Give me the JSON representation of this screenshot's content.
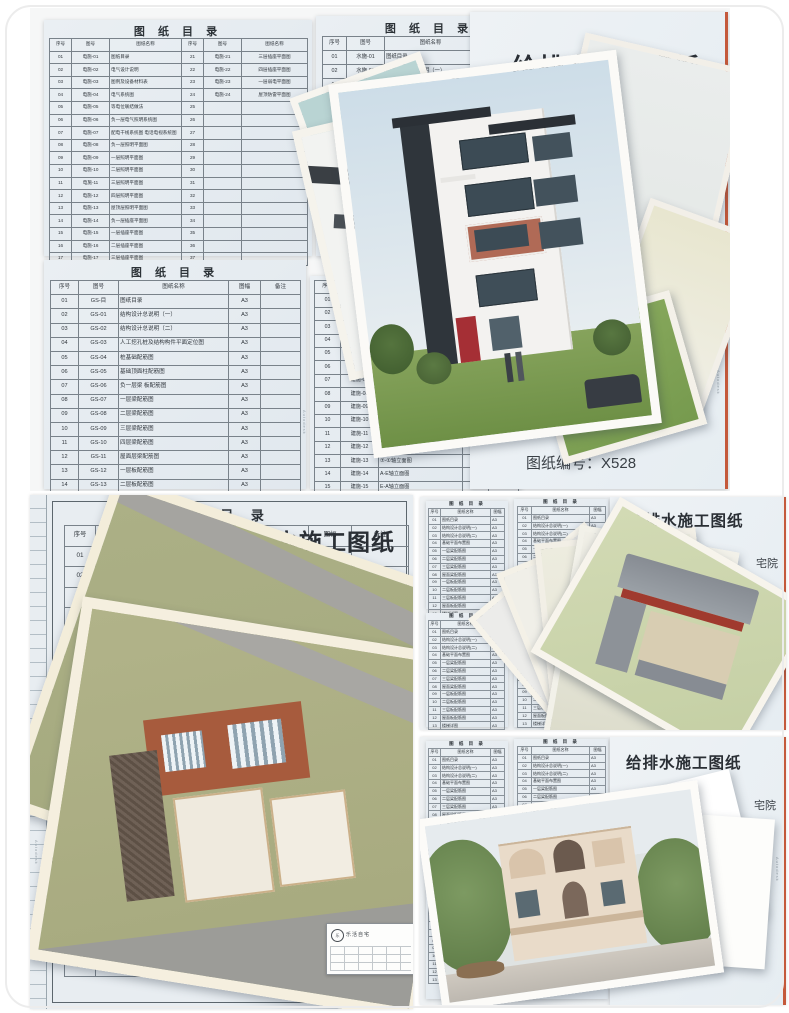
{
  "autodesk": "Autodesk",
  "catalog_title": "图 纸 目 录",
  "top": {
    "dianshi": {
      "heads": [
        "序号",
        "图号",
        "图纸名称",
        "序号",
        "图号",
        "图纸名称"
      ],
      "rows": [
        [
          "01",
          "电施-01",
          "图纸目录",
          "21",
          "电施-21",
          "三层插座平面图"
        ],
        [
          "02",
          "电施-02",
          "电气设计说明",
          "22",
          "电施-22",
          "四层插座平面图"
        ],
        [
          "03",
          "电施-03",
          "图例及设备材料表",
          "23",
          "电施-23",
          "一层弱电平面图"
        ],
        [
          "04",
          "电施-04",
          "电气系统图",
          "24",
          "电施-24",
          "屋顶防雷平面图"
        ],
        [
          "05",
          "电施-05",
          "等电位联结做法",
          "25",
          "",
          ""
        ],
        [
          "06",
          "电施-06",
          "负一层电气照明系统图",
          "26",
          "",
          ""
        ],
        [
          "07",
          "电施-07",
          "配电干线系统图 电话电视系统图",
          "27",
          "",
          ""
        ],
        [
          "08",
          "电施-08",
          "负一层照明平面图",
          "28",
          "",
          ""
        ],
        [
          "09",
          "电施-09",
          "一层照明平面图",
          "29",
          "",
          ""
        ],
        [
          "10",
          "电施-10",
          "二层照明平面图",
          "30",
          "",
          ""
        ],
        [
          "11",
          "电施-11",
          "三层照明平面图",
          "31",
          "",
          ""
        ],
        [
          "12",
          "电施-12",
          "四层照明平面图",
          "32",
          "",
          ""
        ],
        [
          "13",
          "电施-13",
          "屋顶层照明平面图",
          "33",
          "",
          ""
        ],
        [
          "14",
          "电施-14",
          "负一层插座平面图",
          "34",
          "",
          ""
        ],
        [
          "15",
          "电施-15",
          "一层插座平面图",
          "35",
          "",
          ""
        ],
        [
          "16",
          "电施-16",
          "二层插座平面图",
          "36",
          "",
          ""
        ],
        [
          "17",
          "电施-17",
          "三层插座平面图",
          "37",
          "",
          ""
        ]
      ]
    },
    "shuishi": {
      "heads": [
        "序号",
        "图号",
        "图纸名称",
        "图幅",
        "备注"
      ],
      "rows": [
        [
          "01",
          "水施-01",
          "图纸目录",
          "A3",
          ""
        ],
        [
          "02",
          "水施-02",
          "给排水设计总说明（一）",
          "A3",
          ""
        ],
        [
          "03",
          "水施-03",
          "给排水设计总说明（二）",
          "A3",
          ""
        ],
        [
          "04",
          "水施-04",
          "给排水系统图",
          "",
          ""
        ],
        [
          "05",
          "水施-05",
          "给排水系统图",
          "",
          ""
        ],
        [
          "06",
          "水施-06",
          "",
          "",
          ""
        ],
        [
          "07",
          "水施-07",
          "",
          "",
          ""
        ],
        [
          "08",
          "",
          "",
          "",
          ""
        ]
      ]
    },
    "cover1": {
      "title": "给排水施工图纸",
      "partial_name": "别墅",
      "partial_code": "528"
    },
    "gs": {
      "heads": [
        "序号",
        "图号",
        "图纸名称",
        "图幅",
        "备注"
      ],
      "rows": [
        [
          "01",
          "GS-目",
          "图纸目录",
          "A3",
          ""
        ],
        [
          "02",
          "GS-01",
          "结构设计总说明（一）",
          "A3",
          ""
        ],
        [
          "03",
          "GS-02",
          "结构设计总说明（二）",
          "A3",
          ""
        ],
        [
          "04",
          "GS-03",
          "人工挖孔桩及结构构件平面定位图",
          "A3",
          ""
        ],
        [
          "05",
          "GS-04",
          "桩基础配筋图",
          "A3",
          ""
        ],
        [
          "06",
          "GS-05",
          "基础顶面柱配筋图",
          "A3",
          ""
        ],
        [
          "07",
          "GS-06",
          "负一层梁 板配筋图",
          "A3",
          ""
        ],
        [
          "08",
          "GS-07",
          "一层梁配筋图",
          "A3",
          ""
        ],
        [
          "09",
          "GS-08",
          "二层梁配筋图",
          "A3",
          ""
        ],
        [
          "10",
          "GS-09",
          "三层梁配筋图",
          "A3",
          ""
        ],
        [
          "11",
          "GS-10",
          "四层梁配筋图",
          "A3",
          ""
        ],
        [
          "12",
          "GS-11",
          "屋面层梁配筋图",
          "A3",
          ""
        ],
        [
          "13",
          "GS-12",
          "一层板配筋图",
          "A3",
          ""
        ],
        [
          "14",
          "GS-13",
          "二层板配筋图",
          "A3",
          ""
        ]
      ]
    },
    "jianshi": {
      "heads": [
        "序号",
        "图号",
        "图纸名称",
        "图幅",
        "备注"
      ],
      "rows": [
        [
          "01",
          "建施-01",
          "",
          "",
          ""
        ],
        [
          "02",
          "建施-02",
          "",
          "",
          ""
        ],
        [
          "03",
          "建施-03",
          "",
          "",
          ""
        ],
        [
          "04",
          "建施-04",
          "",
          "",
          ""
        ],
        [
          "05",
          "建施-05",
          "",
          "",
          ""
        ],
        [
          "06",
          "建施-06",
          "",
          "",
          ""
        ],
        [
          "07",
          "建施-07",
          "",
          "",
          ""
        ],
        [
          "08",
          "建施-08",
          "",
          "",
          ""
        ],
        [
          "09",
          "建施-09",
          "",
          "",
          ""
        ],
        [
          "10",
          "建施-10",
          "屋顶平面图",
          "",
          ""
        ],
        [
          "11",
          "建施-11",
          "天面层平面图",
          "A3",
          ""
        ],
        [
          "12",
          "建施-12",
          "①-⑦轴立面图",
          "A3",
          ""
        ],
        [
          "13",
          "建施-13",
          "⑦-①轴立面图",
          "A3",
          ""
        ],
        [
          "14",
          "建施-14",
          "A-E轴立面图",
          "A3",
          ""
        ],
        [
          "15",
          "建施-15",
          "E-A轴立面图",
          "A3",
          ""
        ]
      ]
    },
    "cover2": {
      "partial_title": "纸",
      "project": "林周家别墅",
      "code": "图纸编号：X528"
    }
  },
  "bottom_left": {
    "ss": {
      "heads": [
        "序号",
        "图号",
        "图纸名称",
        "图幅",
        "备注"
      ],
      "rows": [
        [
          "01",
          "SS-01",
          "图纸目录",
          "A3",
          ""
        ],
        [
          "02",
          "SS-02",
          "给排水设计说明 图例",
          "A3",
          ""
        ],
        [
          "03",
          "SS-03",
          "给排水平面图",
          "A3",
          ""
        ],
        [
          "04",
          "",
          "",
          "",
          ""
        ],
        [
          "05",
          "",
          "",
          "",
          ""
        ],
        [
          "06",
          "",
          "",
          "",
          ""
        ],
        [
          "07",
          "",
          "",
          "",
          ""
        ],
        [
          "08",
          "",
          "",
          "",
          ""
        ],
        [
          "09",
          "",
          "",
          "",
          ""
        ],
        [
          "10",
          "",
          "",
          "",
          ""
        ],
        [
          "11",
          "",
          "",
          "",
          ""
        ],
        [
          "12",
          "",
          "",
          "",
          ""
        ],
        [
          "13",
          "",
          "",
          "",
          ""
        ],
        [
          "14",
          "",
          "",
          "",
          ""
        ],
        [
          "15",
          "",
          "",
          "",
          ""
        ],
        [
          "16",
          "",
          "",
          "",
          ""
        ],
        [
          "17",
          "",
          "",
          "",
          ""
        ],
        [
          "18",
          "",
          "",
          "",
          ""
        ],
        [
          "19",
          "",
          "",
          "",
          ""
        ],
        [
          "20",
          "",
          "",
          "",
          ""
        ],
        [
          "21",
          "",
          "",
          "",
          ""
        ]
      ]
    },
    "partial_title": "水施工图纸",
    "frag_name1": "张家宅",
    "frag_name2": "张家",
    "frag_code": "编号：X550",
    "stamp_logo": "乐",
    "stamp_text": "乐活自宅"
  },
  "mini": {
    "title": "图 纸 目 录",
    "heads": [
      "序号",
      "图纸名称",
      "图幅"
    ],
    "rows": [
      [
        "01",
        "图纸目录",
        "A3"
      ],
      [
        "02",
        "结构设计总说明(一)",
        "A3"
      ],
      [
        "03",
        "结构设计总说明(二)",
        "A3"
      ],
      [
        "04",
        "基础平面布置图",
        "A3"
      ],
      [
        "05",
        "一层梁配筋图",
        "A3"
      ],
      [
        "06",
        "二层梁配筋图",
        "A3"
      ],
      [
        "07",
        "三层梁配筋图",
        "A3"
      ],
      [
        "08",
        "屋面梁配筋图",
        "A3"
      ],
      [
        "09",
        "一层板配筋图",
        "A3"
      ],
      [
        "10",
        "二层板配筋图",
        "A3"
      ],
      [
        "11",
        "三层板配筋图",
        "A3"
      ],
      [
        "12",
        "屋面板配筋图",
        "A3"
      ],
      [
        "13",
        "楼梯详图",
        "A3"
      ]
    ]
  },
  "bottom_right_top": {
    "title": "给排水施工图纸",
    "partial_name": "宅院"
  },
  "bottom_right_bottom": {
    "title": "给排水施工图纸",
    "partial_name": "宅院",
    "code": "图纸编号：X526"
  }
}
